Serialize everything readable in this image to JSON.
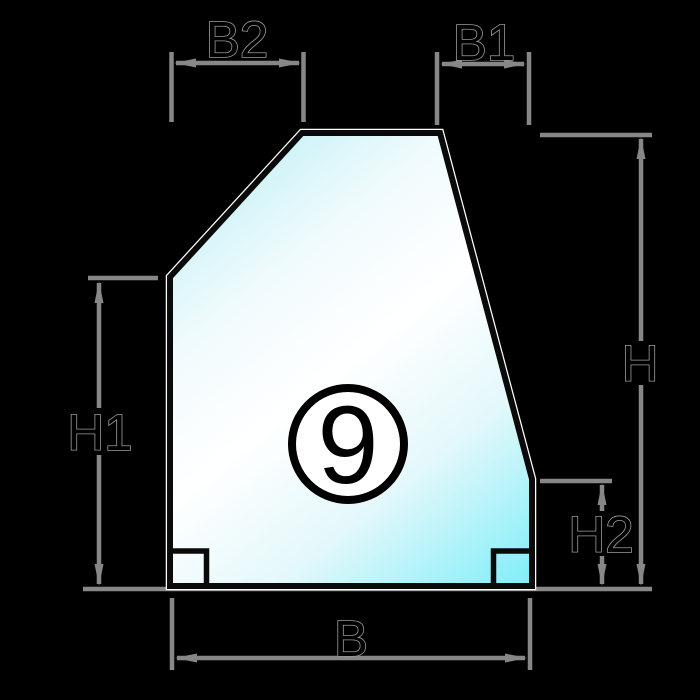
{
  "figure": {
    "badge_number": "9"
  },
  "labels": {
    "B2": "B2",
    "B1": "B1",
    "H": "H",
    "H1": "H1",
    "H2": "H2",
    "B": "B"
  },
  "colors": {
    "bg": "#000000",
    "outline": "#0a0a0a",
    "edge-highlight": "#ffffff",
    "dim-line": "#878787",
    "label-fill": "#000000",
    "label-stroke": "#9a9a9a",
    "glass-1": "#b2edf4",
    "glass-2": "#f0fbfd",
    "glass-3": "#ffffff",
    "glass-4": "#e4f8fb",
    "glass-5": "#7eeef8",
    "badge-fill": "#ffffff",
    "badge-stroke": "#000000"
  }
}
